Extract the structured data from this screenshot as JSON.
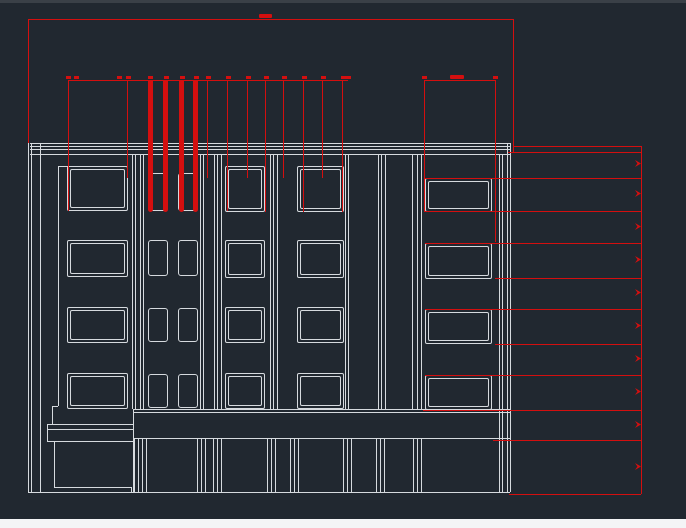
{
  "app": {
    "background_color": "#212830",
    "top_strip_color": "#3a4047",
    "bottom_bar_color": "#f4f5f6",
    "drawing_line_color": "#d6dade",
    "dimension_color": "#d40f0f"
  },
  "drawing": {
    "white_hlines": [
      [
        30,
        143,
        510
      ],
      [
        30,
        146,
        510
      ],
      [
        30,
        149,
        510
      ],
      [
        30,
        154,
        510
      ],
      [
        58,
        166,
        68
      ],
      [
        52,
        406,
        58
      ],
      [
        133,
        409,
        510
      ],
      [
        133,
        412,
        510
      ],
      [
        133,
        438,
        510
      ],
      [
        47,
        424,
        133
      ],
      [
        47,
        429,
        133
      ],
      [
        47,
        441,
        133
      ],
      [
        54,
        487,
        131
      ],
      [
        28,
        492,
        510
      ]
    ],
    "white_vlines": [
      [
        28,
        143,
        492
      ],
      [
        31,
        143,
        492
      ],
      [
        40,
        143,
        492
      ],
      [
        58,
        166,
        406
      ],
      [
        47,
        424,
        441
      ],
      [
        52,
        406,
        424
      ],
      [
        133,
        409,
        492
      ],
      [
        54,
        441,
        487
      ],
      [
        131,
        487,
        492
      ],
      [
        132,
        155,
        409
      ],
      [
        135,
        155,
        409
      ],
      [
        140,
        155,
        409
      ],
      [
        143,
        155,
        409
      ],
      [
        200,
        155,
        409
      ],
      [
        203,
        155,
        409
      ],
      [
        214,
        155,
        409
      ],
      [
        217,
        155,
        409
      ],
      [
        221,
        155,
        409
      ],
      [
        270,
        155,
        409
      ],
      [
        273,
        155,
        409
      ],
      [
        277,
        155,
        409
      ],
      [
        345,
        155,
        409
      ],
      [
        348,
        155,
        409
      ],
      [
        378,
        155,
        409
      ],
      [
        381,
        155,
        409
      ],
      [
        385,
        155,
        409
      ],
      [
        412,
        155,
        409
      ],
      [
        417,
        155,
        409
      ],
      [
        421,
        155,
        409
      ],
      [
        499,
        155,
        492
      ],
      [
        502,
        155,
        492
      ],
      [
        507,
        143,
        492
      ],
      [
        510,
        143,
        492
      ],
      [
        134,
        438,
        492
      ],
      [
        138,
        438,
        492
      ],
      [
        142,
        438,
        492
      ],
      [
        146,
        438,
        492
      ],
      [
        197,
        438,
        492
      ],
      [
        201,
        438,
        492
      ],
      [
        205,
        438,
        492
      ],
      [
        213,
        438,
        492
      ],
      [
        217,
        438,
        492
      ],
      [
        221,
        438,
        492
      ],
      [
        267,
        438,
        492
      ],
      [
        271,
        438,
        492
      ],
      [
        275,
        438,
        492
      ],
      [
        290,
        438,
        492
      ],
      [
        294,
        438,
        492
      ],
      [
        298,
        438,
        492
      ],
      [
        343,
        438,
        492
      ],
      [
        347,
        438,
        492
      ],
      [
        351,
        438,
        492
      ],
      [
        376,
        438,
        492
      ],
      [
        380,
        438,
        492
      ],
      [
        384,
        438,
        492
      ],
      [
        413,
        438,
        492
      ],
      [
        417,
        438,
        492
      ],
      [
        421,
        438,
        492
      ]
    ],
    "windows_large": [
      [
        67,
        166,
        61,
        45
      ],
      [
        67,
        240,
        61,
        37
      ],
      [
        67,
        307,
        61,
        36
      ],
      [
        67,
        373,
        61,
        36
      ],
      [
        225,
        166,
        40,
        46
      ],
      [
        225,
        240,
        40,
        38
      ],
      [
        225,
        307,
        40,
        36
      ],
      [
        225,
        373,
        40,
        36
      ],
      [
        297,
        166,
        47,
        46
      ],
      [
        297,
        240,
        47,
        38
      ],
      [
        297,
        307,
        47,
        36
      ],
      [
        297,
        373,
        47,
        36
      ],
      [
        425,
        178,
        67,
        34
      ],
      [
        425,
        243,
        67,
        36
      ],
      [
        425,
        309,
        67,
        35
      ],
      [
        425,
        375,
        67,
        35
      ]
    ],
    "windows_small": [
      [
        148,
        173,
        20,
        38
      ],
      [
        178,
        173,
        20,
        38
      ],
      [
        148,
        240,
        20,
        36
      ],
      [
        178,
        240,
        20,
        36
      ],
      [
        148,
        308,
        20,
        34
      ],
      [
        178,
        308,
        20,
        34
      ],
      [
        148,
        374,
        20,
        34
      ],
      [
        178,
        374,
        20,
        34
      ]
    ],
    "red_hlines": [
      [
        28,
        19,
        513
      ],
      [
        68,
        80,
        348
      ],
      [
        424,
        80,
        495
      ],
      [
        513,
        146,
        641
      ],
      [
        508,
        152,
        641
      ],
      [
        424,
        178,
        641
      ],
      [
        424,
        211,
        641
      ],
      [
        425,
        243,
        641
      ],
      [
        495,
        278,
        641
      ],
      [
        425,
        309,
        641
      ],
      [
        495,
        344,
        641
      ],
      [
        425,
        375,
        641
      ],
      [
        423,
        410,
        641
      ],
      [
        493,
        440,
        641
      ],
      [
        509,
        494,
        641
      ]
    ],
    "red_vlines": [
      [
        28,
        19,
        143
      ],
      [
        513,
        19,
        152
      ],
      [
        68,
        80,
        211
      ],
      [
        127,
        80,
        178
      ],
      [
        207,
        80,
        178
      ],
      [
        227,
        80,
        211
      ],
      [
        247,
        80,
        178
      ],
      [
        265,
        80,
        212
      ],
      [
        283,
        80,
        178
      ],
      [
        303,
        80,
        212
      ],
      [
        322,
        80,
        178
      ],
      [
        342,
        80,
        212
      ],
      [
        424,
        80,
        211
      ],
      [
        495,
        80,
        242
      ],
      [
        641,
        146,
        494
      ]
    ],
    "red_thick_vlines": [
      [
        148,
        80,
        212
      ],
      [
        163,
        80,
        212
      ],
      [
        179,
        80,
        212
      ],
      [
        193,
        80,
        212
      ]
    ],
    "dimension_ticks": [
      [
        66,
        76
      ],
      [
        74,
        76
      ],
      [
        117,
        76
      ],
      [
        126,
        76
      ],
      [
        148,
        76
      ],
      [
        164,
        76
      ],
      [
        180,
        76
      ],
      [
        194,
        76
      ],
      [
        206,
        76
      ],
      [
        226,
        76
      ],
      [
        246,
        76
      ],
      [
        264,
        76
      ],
      [
        282,
        76
      ],
      [
        302,
        76
      ],
      [
        321,
        76
      ],
      [
        341,
        76
      ],
      [
        346,
        76
      ],
      [
        422,
        76
      ],
      [
        493,
        76
      ]
    ],
    "dimension_text_marks": [
      [
        259,
        14,
        13,
        4
      ],
      [
        450,
        75,
        14,
        4
      ]
    ],
    "dimension_arrows": [
      [
        635,
        160
      ],
      [
        635,
        190
      ],
      [
        635,
        223
      ],
      [
        635,
        256
      ],
      [
        635,
        289
      ],
      [
        635,
        322
      ],
      [
        635,
        355
      ],
      [
        635,
        388
      ],
      [
        635,
        421
      ],
      [
        635,
        463
      ]
    ]
  }
}
